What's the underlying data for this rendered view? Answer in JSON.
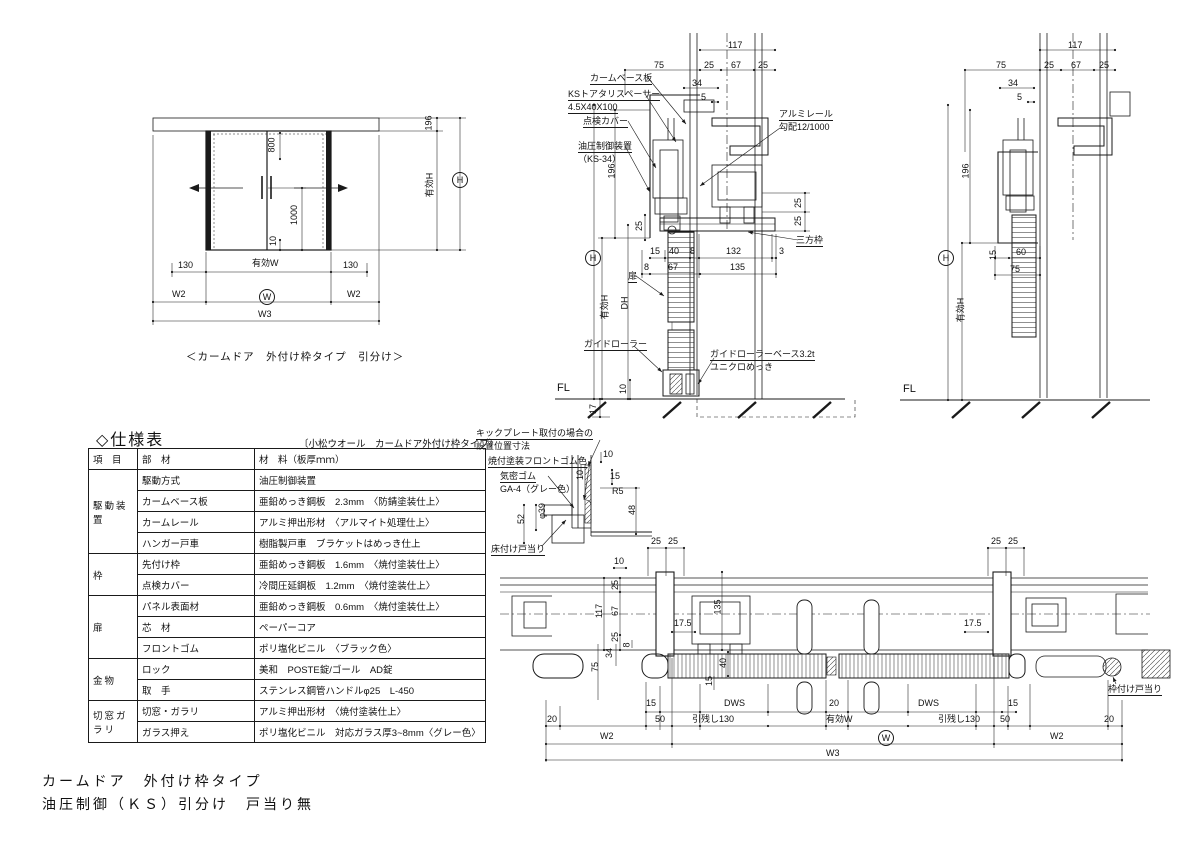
{
  "page": {
    "bg": "#ffffff",
    "line_color": "#1a1a1a"
  },
  "titles": {
    "main_line1": "カームドア　外付け枠タイプ",
    "main_line2": "油圧制御（ＫＳ）引分け　戸当り無"
  },
  "elevation": {
    "caption": "＜カームドア　外付け枠タイプ　引分け＞"
  },
  "spec_table": {
    "title": "◇仕様表",
    "subtitle": "〔小松ウオール　カームドア外付け枠タイプ〕",
    "headers": [
      "項　目",
      "部　材",
      "材　料（板厚ｍｍ）"
    ],
    "groups": [
      {
        "name": "駆動装置",
        "rows": [
          {
            "part": "駆動方式",
            "material": "油圧制御装置"
          },
          {
            "part": "カームベース板",
            "material": "亜鉛めっき鋼板　2.3mm　〈防錆塗装仕上〉"
          },
          {
            "part": "カームレール",
            "material": "アルミ押出形材　〈アルマイト処理仕上〉"
          },
          {
            "part": "ハンガー戸車",
            "material": "樹脂製戸車　ブラケットはめっき仕上"
          }
        ]
      },
      {
        "name": "枠",
        "rows": [
          {
            "part": "先付け枠",
            "material": "亜鉛めっき鋼板　1.6mm　〈焼付塗装仕上〉"
          },
          {
            "part": "点検カバー",
            "material": "冷間圧延鋼板　1.2mm　〈焼付塗装仕上〉"
          }
        ]
      },
      {
        "name": "扉",
        "rows": [
          {
            "part": "パネル表面材",
            "material": "亜鉛めっき鋼板　0.6mm　〈焼付塗装仕上〉"
          },
          {
            "part": "芯　材",
            "material": "ペーパーコア"
          },
          {
            "part": "フロントゴム",
            "material": "ポリ塩化ビニル　〈ブラック色〉"
          }
        ]
      },
      {
        "name": "金物",
        "rows": [
          {
            "part": "ロック",
            "material": "美和　POSTE錠/ゴール　AD錠"
          },
          {
            "part": "取　手",
            "material": "ステンレス鋼管ハンドルφ25　L-450"
          }
        ]
      },
      {
        "name": "切窓ガラリ",
        "rows": [
          {
            "part": "切窓・ガラリ",
            "material": "アルミ押出形材　〈焼付塗装仕上〉"
          },
          {
            "part": "ガラス押え",
            "material": "ポリ塩化ビニル　対応ガラス厚3~8mm〈グレー色〉"
          }
        ]
      }
    ]
  },
  "labels": {
    "elevation": [
      {
        "n": "dim-800",
        "t": "800",
        "x": 264,
        "y": 140,
        "r": 1
      },
      {
        "n": "dim-1000",
        "t": "1000",
        "x": 284,
        "y": 210,
        "r": 1
      },
      {
        "n": "dim-10-floor",
        "t": "10",
        "x": 268,
        "y": 236,
        "r": 1
      },
      {
        "n": "dim-196",
        "t": "196",
        "x": 421,
        "y": 118,
        "r": 1
      },
      {
        "n": "dim-yuko-h",
        "t": "有効H",
        "x": 417,
        "y": 180,
        "r": 1
      },
      {
        "n": "dim-h-circle",
        "t": "H",
        "x": 452,
        "y": 172,
        "c": 1
      },
      {
        "n": "dim-130-left",
        "t": "130",
        "x": 178,
        "y": 260
      },
      {
        "n": "dim-yuko-w",
        "t": "有効W",
        "x": 252,
        "y": 258
      },
      {
        "n": "dim-130-right",
        "t": "130",
        "x": 343,
        "y": 260
      },
      {
        "n": "dim-w2-left",
        "t": "W2",
        "x": 172,
        "y": 289
      },
      {
        "n": "dim-w-circle",
        "t": "W",
        "x": 259,
        "y": 289,
        "c": 1
      },
      {
        "n": "dim-w2-right",
        "t": "W2",
        "x": 347,
        "y": 289
      },
      {
        "n": "dim-w3",
        "t": "W3",
        "x": 258,
        "y": 309
      }
    ],
    "section_mid": [
      {
        "n": "dim-117",
        "t": "117",
        "x": 728,
        "y": 40
      },
      {
        "t": "75",
        "x": 654,
        "y": 60
      },
      {
        "t": "25",
        "x": 704,
        "y": 60
      },
      {
        "t": "67",
        "x": 731,
        "y": 60
      },
      {
        "t": "25",
        "x": 758,
        "y": 60
      },
      {
        "t": "34",
        "x": 692,
        "y": 78
      },
      {
        "t": "5",
        "x": 701,
        "y": 92
      },
      {
        "n": "label-calm-base-plate",
        "t": "カームベース板",
        "x": 590,
        "y": 73,
        "u": 1
      },
      {
        "n": "label-ks-spacer",
        "t": "KSトアタリスペーサー",
        "x": 568,
        "y": 89,
        "u": 1
      },
      {
        "n": "label-ks-spacer-size",
        "t": "4.5X40X100",
        "x": 568,
        "y": 102,
        "u": 1
      },
      {
        "n": "label-inspection-cover",
        "t": "点検カバー",
        "x": 583,
        "y": 116,
        "u": 1
      },
      {
        "n": "label-hydraulic-unit",
        "t": "油圧制御装置",
        "x": 578,
        "y": 141,
        "u": 1
      },
      {
        "n": "label-hydraulic-model",
        "t": "（KS-34）",
        "x": 578,
        "y": 154
      },
      {
        "n": "label-alumi-rail",
        "t": "アルミレール",
        "x": 779,
        "y": 109,
        "u": 1
      },
      {
        "n": "label-rail-slope",
        "t": "勾配12/1000",
        "x": 779,
        "y": 122
      },
      {
        "t": "196",
        "x": 604,
        "y": 166,
        "r": 1
      },
      {
        "t": "25",
        "x": 634,
        "y": 221,
        "r": 1
      },
      {
        "t": "25",
        "x": 793,
        "y": 198,
        "r": 1
      },
      {
        "t": "25",
        "x": 793,
        "y": 216,
        "r": 1
      },
      {
        "n": "label-sanpo-waku",
        "t": "三方枠",
        "x": 796,
        "y": 235,
        "u": 1
      },
      {
        "t": "15",
        "x": 650,
        "y": 246
      },
      {
        "t": "40",
        "x": 669,
        "y": 246
      },
      {
        "t": "8",
        "x": 690,
        "y": 246
      },
      {
        "t": "132",
        "x": 726,
        "y": 246
      },
      {
        "t": "3",
        "x": 779,
        "y": 246
      },
      {
        "t": "8",
        "x": 644,
        "y": 262
      },
      {
        "t": "67",
        "x": 668,
        "y": 262
      },
      {
        "t": "135",
        "x": 730,
        "y": 262
      },
      {
        "n": "dim-h-circle-mid",
        "t": "H",
        "x": 585,
        "y": 250,
        "c": 1
      },
      {
        "t": "有効H",
        "x": 592,
        "y": 302,
        "r": 1
      },
      {
        "t": "DH",
        "x": 618,
        "y": 298,
        "r": 1
      },
      {
        "n": "label-door",
        "t": "扉",
        "x": 628,
        "y": 271,
        "u": 1
      },
      {
        "n": "label-guide-roller",
        "t": "ガイドローラー",
        "x": 584,
        "y": 339,
        "u": 1
      },
      {
        "n": "label-guide-roller-base",
        "t": "ガイドローラーベース3.2t",
        "x": 710,
        "y": 349,
        "u": 1
      },
      {
        "n": "label-unichro",
        "t": "ユニクロめっき",
        "x": 710,
        "y": 362
      },
      {
        "n": "label-fl-mid",
        "t": "FL",
        "x": 557,
        "y": 383,
        "fs": 11
      },
      {
        "t": "10",
        "x": 618,
        "y": 384,
        "r": 1
      },
      {
        "t": "17",
        "x": 588,
        "y": 404,
        "r": 1
      }
    ],
    "section_right": [
      {
        "t": "117",
        "x": 1068,
        "y": 40
      },
      {
        "t": "75",
        "x": 996,
        "y": 60
      },
      {
        "t": "25",
        "x": 1044,
        "y": 60
      },
      {
        "t": "67",
        "x": 1071,
        "y": 60
      },
      {
        "t": "25",
        "x": 1099,
        "y": 60
      },
      {
        "t": "34",
        "x": 1008,
        "y": 78
      },
      {
        "t": "5",
        "x": 1017,
        "y": 92
      },
      {
        "t": "196",
        "x": 958,
        "y": 166,
        "r": 1
      },
      {
        "n": "dim-h-circle-right",
        "t": "H",
        "x": 938,
        "y": 250,
        "c": 1
      },
      {
        "t": "有効H",
        "x": 948,
        "y": 305,
        "r": 1
      },
      {
        "t": "15",
        "x": 988,
        "y": 250,
        "r": 1
      },
      {
        "t": "60",
        "x": 1016,
        "y": 247
      },
      {
        "t": "75",
        "x": 1010,
        "y": 264
      },
      {
        "n": "label-fl-right",
        "t": "FL",
        "x": 903,
        "y": 384,
        "fs": 11
      }
    ],
    "detail": [
      {
        "n": "label-kickplate-1",
        "t": "キックプレート取付の場合の",
        "x": 476,
        "y": 428,
        "u": 1
      },
      {
        "n": "label-kickplate-2",
        "t": "設置位置寸法",
        "x": 476,
        "y": 441
      },
      {
        "n": "label-front-rubber",
        "t": "焼付塗装フロントゴム色",
        "x": 488,
        "y": 456,
        "u": 1
      },
      {
        "n": "label-kimitsu-rubber",
        "t": "気密ゴム",
        "x": 500,
        "y": 471,
        "u": 1
      },
      {
        "n": "label-ga4",
        "t": "GA-4（グレー色）",
        "x": 500,
        "y": 484
      },
      {
        "t": "10",
        "x": 603,
        "y": 449
      },
      {
        "t": "15",
        "x": 610,
        "y": 471
      },
      {
        "t": "R5",
        "x": 612,
        "y": 486
      },
      {
        "t": "48",
        "x": 627,
        "y": 505,
        "r": 1
      },
      {
        "t": "10",
        "x": 575,
        "y": 470,
        "r": 1
      },
      {
        "t": "φ39",
        "x": 534,
        "y": 506,
        "r": 1
      },
      {
        "t": "52",
        "x": 516,
        "y": 514,
        "r": 1
      },
      {
        "n": "label-floor-stop",
        "t": "床付け戸当り",
        "x": 491,
        "y": 544,
        "u": 1
      }
    ],
    "plan": [
      {
        "t": "25",
        "x": 651,
        "y": 536
      },
      {
        "t": "25",
        "x": 668,
        "y": 536
      },
      {
        "t": "25",
        "x": 991,
        "y": 536
      },
      {
        "t": "25",
        "x": 1008,
        "y": 536
      },
      {
        "t": "10",
        "x": 614,
        "y": 556
      },
      {
        "t": "25",
        "x": 610,
        "y": 580,
        "r": 1
      },
      {
        "t": "117",
        "x": 592,
        "y": 606,
        "r": 1
      },
      {
        "t": "67",
        "x": 610,
        "y": 606,
        "r": 1
      },
      {
        "t": "25",
        "x": 610,
        "y": 632,
        "r": 1
      },
      {
        "t": "34",
        "x": 604,
        "y": 648,
        "r": 1
      },
      {
        "t": "8",
        "x": 624,
        "y": 640,
        "r": 1
      },
      {
        "t": "75",
        "x": 590,
        "y": 662,
        "r": 1
      },
      {
        "t": "135",
        "x": 710,
        "y": 602,
        "r": 1
      },
      {
        "t": "17.5",
        "x": 674,
        "y": 618
      },
      {
        "t": "17.5",
        "x": 964,
        "y": 618
      },
      {
        "t": "40",
        "x": 718,
        "y": 658,
        "r": 1
      },
      {
        "t": "15",
        "x": 704,
        "y": 676,
        "r": 1
      },
      {
        "t": "15",
        "x": 646,
        "y": 698
      },
      {
        "n": "dim-dws-left",
        "t": "DWS",
        "x": 724,
        "y": 698
      },
      {
        "t": "20",
        "x": 829,
        "y": 698
      },
      {
        "n": "dim-dws-right",
        "t": "DWS",
        "x": 918,
        "y": 698
      },
      {
        "t": "15",
        "x": 1008,
        "y": 698
      },
      {
        "t": "20",
        "x": 547,
        "y": 714
      },
      {
        "t": "50",
        "x": 655,
        "y": 714
      },
      {
        "n": "dim-hikinokoshi-left",
        "t": "引残し130",
        "x": 692,
        "y": 714
      },
      {
        "n": "dim-yuko-w-plan",
        "t": "有効W",
        "x": 826,
        "y": 714
      },
      {
        "n": "dim-hikinokoshi-right",
        "t": "引残し130",
        "x": 938,
        "y": 714
      },
      {
        "t": "50",
        "x": 1000,
        "y": 714
      },
      {
        "t": "20",
        "x": 1104,
        "y": 714
      },
      {
        "t": "W2",
        "x": 600,
        "y": 731
      },
      {
        "n": "dim-w-circle-plan",
        "t": "W",
        "x": 878,
        "y": 730,
        "c": 1
      },
      {
        "t": "W2",
        "x": 1050,
        "y": 731
      },
      {
        "t": "W3",
        "x": 826,
        "y": 748
      },
      {
        "n": "label-frame-stop",
        "t": "枠付け戸当り",
        "x": 1108,
        "y": 684,
        "u": 1
      }
    ]
  }
}
